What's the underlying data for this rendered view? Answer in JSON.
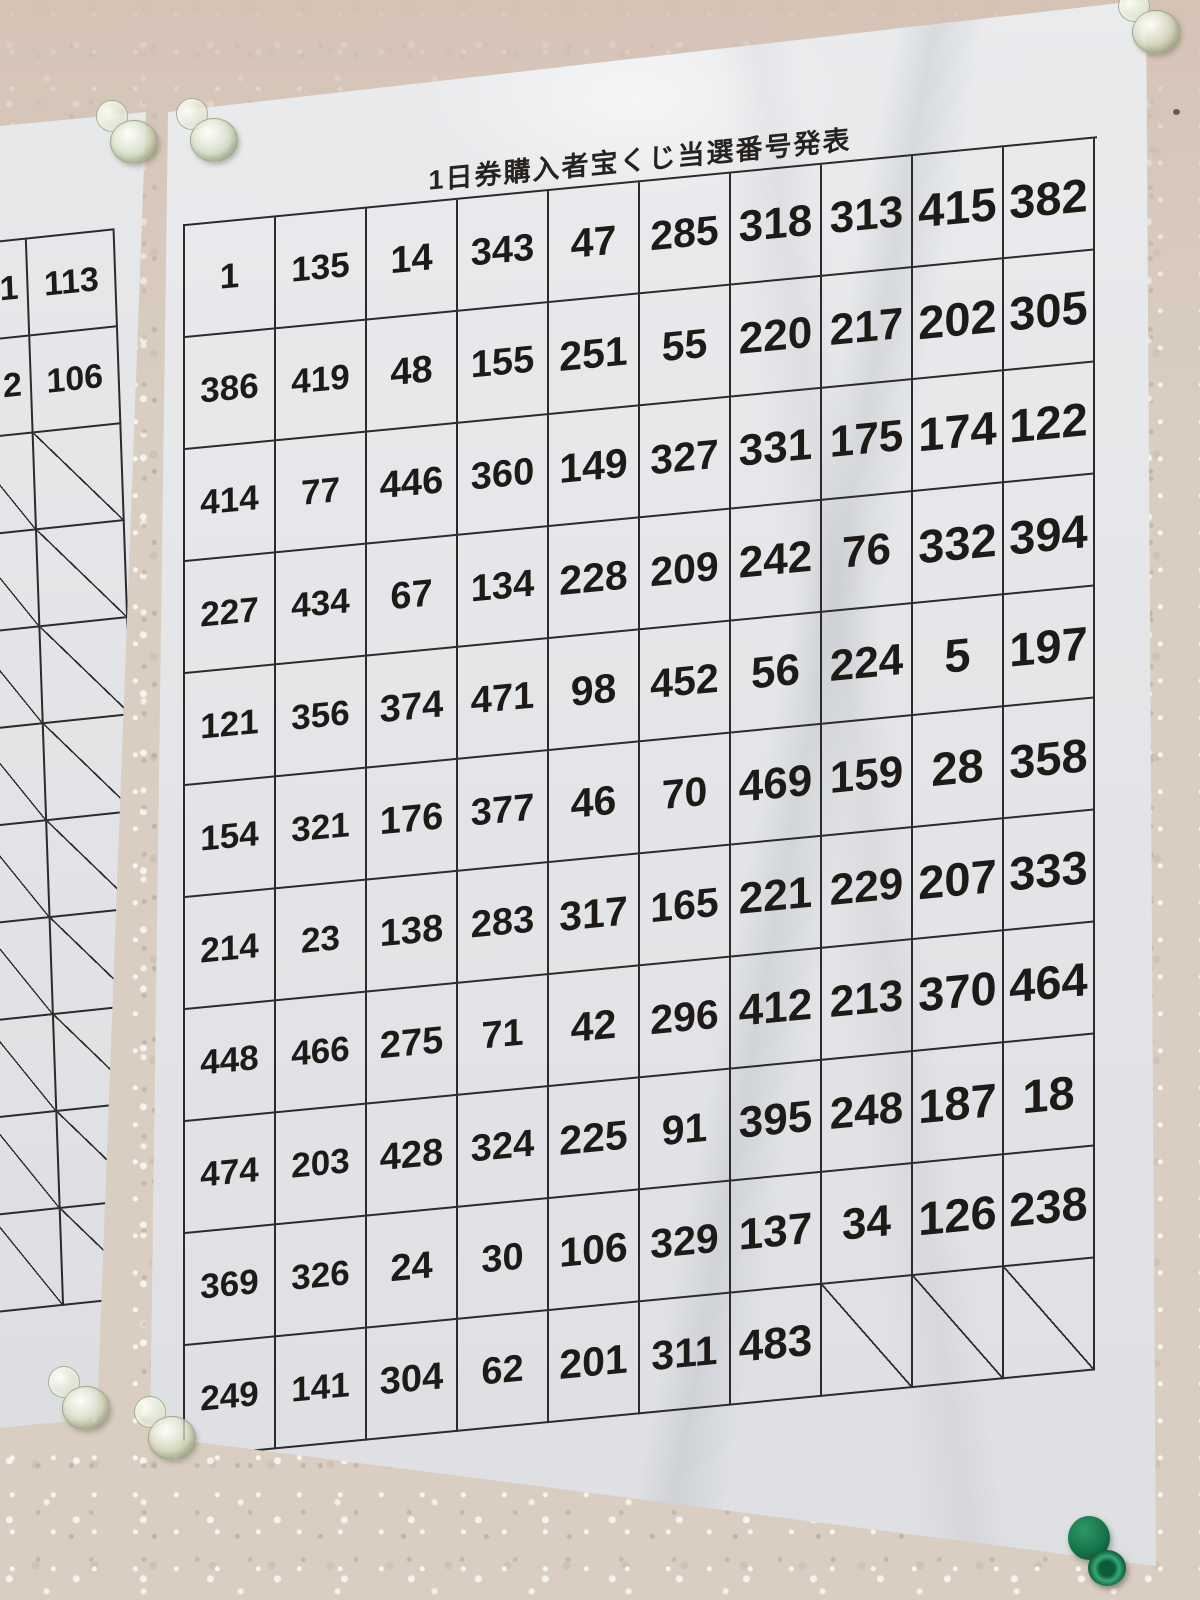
{
  "poster": {
    "title": "1日券購入者宝くじ当選番号発表",
    "table_rows": [
      [
        "1",
        "135",
        "14",
        "343",
        "47",
        "285",
        "318",
        "313",
        "415",
        "382"
      ],
      [
        "386",
        "419",
        "48",
        "155",
        "251",
        "55",
        "220",
        "217",
        "202",
        "305"
      ],
      [
        "414",
        "77",
        "446",
        "360",
        "149",
        "327",
        "331",
        "175",
        "174",
        "122"
      ],
      [
        "227",
        "434",
        "67",
        "134",
        "228",
        "209",
        "242",
        "76",
        "332",
        "394"
      ],
      [
        "121",
        "356",
        "374",
        "471",
        "98",
        "452",
        "56",
        "224",
        "5",
        "197"
      ],
      [
        "154",
        "321",
        "176",
        "377",
        "46",
        "70",
        "469",
        "159",
        "28",
        "358"
      ],
      [
        "214",
        "23",
        "138",
        "283",
        "317",
        "165",
        "221",
        "229",
        "207",
        "333"
      ],
      [
        "448",
        "466",
        "275",
        "71",
        "42",
        "296",
        "412",
        "213",
        "370",
        "464"
      ],
      [
        "474",
        "203",
        "428",
        "324",
        "225",
        "91",
        "395",
        "248",
        "187",
        "18"
      ],
      [
        "369",
        "326",
        "24",
        "30",
        "106",
        "329",
        "137",
        "34",
        "126",
        "238"
      ],
      [
        "249",
        "141",
        "304",
        "62",
        "201",
        "311",
        "483",
        "/",
        "/",
        "/"
      ]
    ]
  },
  "left_poster": {
    "table_rows": [
      [
        "1",
        "113"
      ],
      [
        "2",
        "106"
      ],
      [
        "/",
        "/"
      ],
      [
        "/",
        "/"
      ],
      [
        "/",
        "/"
      ],
      [
        "/",
        "/"
      ],
      [
        "/",
        "/"
      ],
      [
        "/",
        "/"
      ],
      [
        "/",
        "/"
      ],
      [
        "/",
        "/"
      ],
      [
        "/",
        "/"
      ]
    ]
  },
  "colors": {
    "paper": "#e4e6e8",
    "wall": "#d9cec1",
    "table_line": "#2b2b2b",
    "green_pin": "#15744a",
    "clear_pin": "#e9eede"
  }
}
